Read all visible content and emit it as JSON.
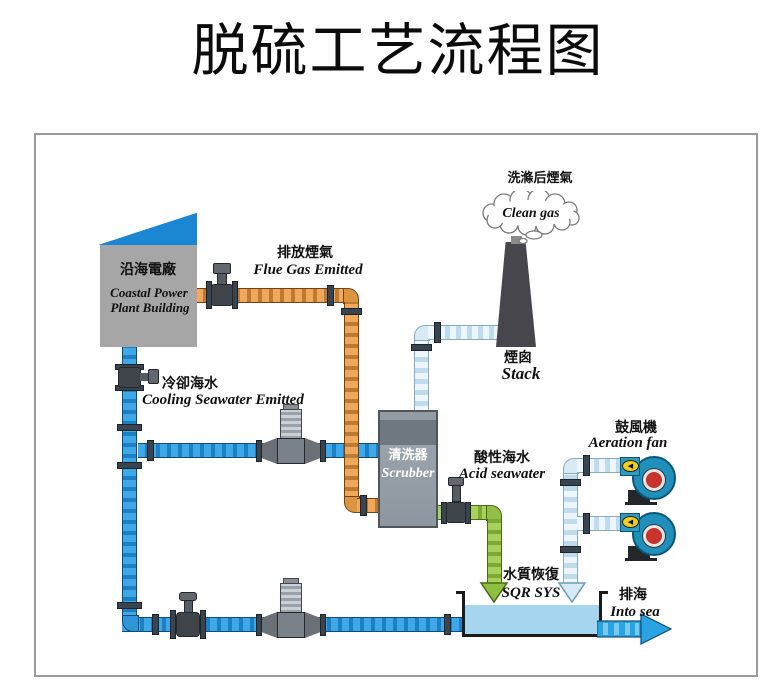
{
  "title": "脱硫工艺流程图",
  "labels": {
    "clean_gas_cn": "洗滌后煙氣",
    "clean_gas_en": "Clean gas",
    "plant_cn": "沿海電廠",
    "plant_en1": "Coastal Power",
    "plant_en2": "Plant Building",
    "flue_cn": "排放煙氣",
    "flue_en": "Flue Gas Emitted",
    "cooling_cn": "冷卻海水",
    "cooling_en": "Cooling Seawater Emitted",
    "stack_cn": "煙囪",
    "stack_en": "Stack",
    "scrubber_cn": "清洗器",
    "scrubber_en": "Scrubber",
    "acid_cn": "酸性海水",
    "acid_en": "Acid seawater",
    "fan_cn": "鼓風機",
    "fan_en": "Aeration fan",
    "sqr_cn": "水質恢復",
    "sqr_en": "SQR SYS",
    "sea_cn": "排海",
    "sea_en": "Into sea",
    "fan_arrow": "◀"
  },
  "colors": {
    "flue_gas_pipe": "#E8A050",
    "seawater_pipe": "#2E95D8",
    "clean_gas_pipe": "#D9EAF5",
    "acid_seawater_pipe": "#93BE48",
    "building_roof": "#1B87D4",
    "building_body": "#A6A6A6",
    "scrubber_body": "#8D969E",
    "stack_body": "#46464C",
    "tank_water": "#A5D5EF",
    "fan_body": "#1F90BC",
    "fan_hub": "#C8332B",
    "fan_badge": "#F2CF1D",
    "into_sea_arrow": "#2AA3E3"
  }
}
